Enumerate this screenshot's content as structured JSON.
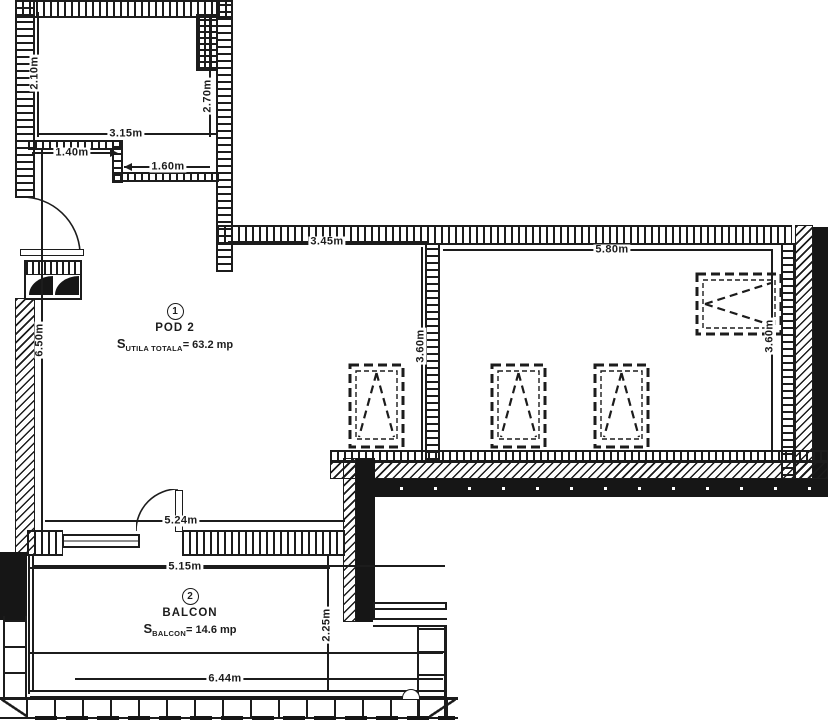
{
  "plan": {
    "rooms": [
      {
        "number": "1",
        "name": "POD 2",
        "area_symbol": "S",
        "area_subscript": "UTILA TOTALA",
        "area_value": "= 63.2 mp"
      },
      {
        "number": "2",
        "name": "BALCON",
        "area_symbol": "S",
        "area_subscript": "BALCON",
        "area_value": "= 14.6 mp"
      }
    ],
    "dimensions": {
      "closet_left_height": "2.10m",
      "closet_right_height": "2.70m",
      "closet_width": "3.15m",
      "closet_nook_left": "1.40m",
      "closet_nook_right": "1.60m",
      "main_top_left": "3.45m",
      "main_top_right": "5.80m",
      "main_left_height": "6.50m",
      "partition_height": "3.60m",
      "right_side_height": "3.60m",
      "main_bottom_width": "5.24m",
      "balcony_top_width": "5.15m",
      "balcony_depth": "2.25m",
      "balcony_bottom_width": "6.44m"
    },
    "ink_color": "#1c1c1c",
    "paper_color": "#ffffff"
  }
}
